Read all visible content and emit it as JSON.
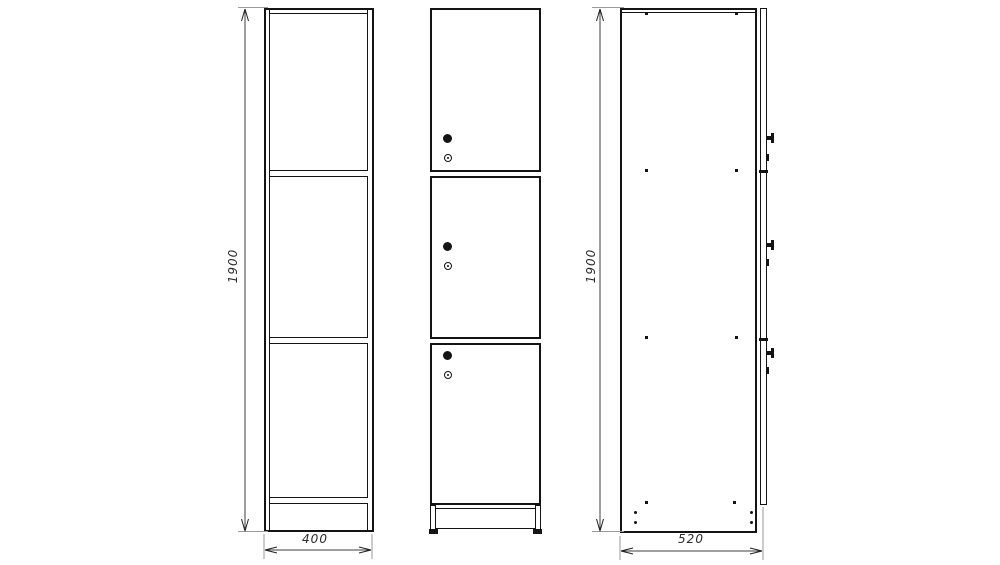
{
  "drawing": {
    "kind": "furniture technical drawing, three orthographic views of a 3-door locker cabinet",
    "colors": {
      "background": "#ffffff",
      "outline": "#141414",
      "dim_line": "#3c3c3c",
      "ext_line": "#9a9a9a",
      "label": "#2b2b2b"
    },
    "views": {
      "front_carcass": "front view without doors: two side panels, top board, two shelves and bottom board",
      "front_doors": "front view with three doors, each with round knob and cylinder lock, plinth with feet",
      "side": "side view with door edge, knobs, locks and fastener dots"
    }
  },
  "dims": {
    "front_height": "1900",
    "front_width": "400",
    "side_height": "1900",
    "side_depth": "520"
  }
}
